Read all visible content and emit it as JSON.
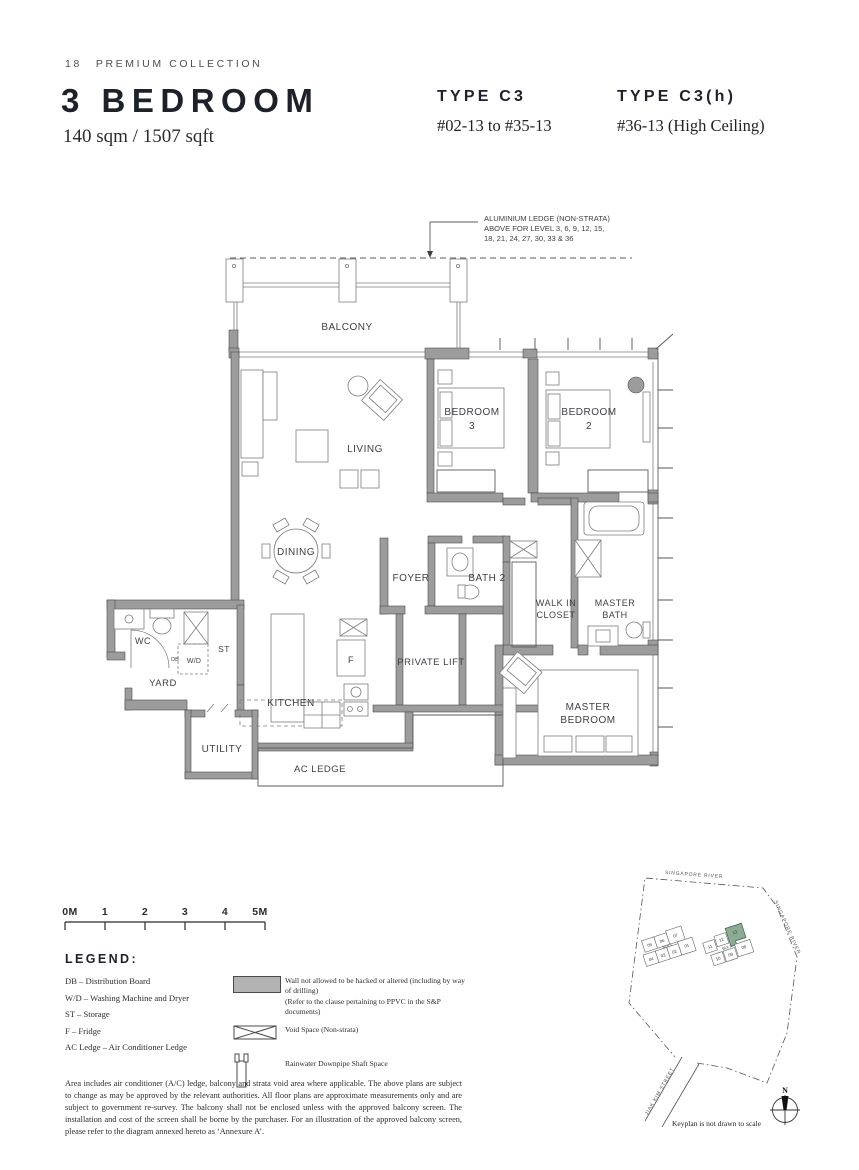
{
  "header": {
    "page_number": "18",
    "collection": "PREMIUM COLLECTION",
    "title": "3 BEDROOM",
    "area": "140 sqm / 1507 sqft",
    "type1": {
      "name": "TYPE C3",
      "units": "#02-13 to #35-13"
    },
    "type2": {
      "name": "TYPE C3(h)",
      "units": "#36-13 (High Ceiling)"
    }
  },
  "annotation": {
    "lines": [
      "ALUMINIUM LEDGE (NON-STRATA)",
      "ABOVE FOR LEVEL 3, 6, 9, 12, 15,",
      "18, 21, 24, 27, 30, 33 & 36"
    ]
  },
  "plan": {
    "balcony": "BALCONY",
    "living": "LIVING",
    "bedroom3": [
      "BEDROOM",
      "3"
    ],
    "bedroom2": [
      "BEDROOM",
      "2"
    ],
    "dining": "DINING",
    "foyer": "FOYER",
    "bath2": "BATH 2",
    "walk_in_closet": [
      "WALK IN",
      "CLOSET"
    ],
    "master_bath": [
      "MASTER",
      "BATH"
    ],
    "private_lift": "PRIVATE LIFT",
    "master_bedroom": [
      "MASTER",
      "BEDROOM"
    ],
    "kitchen": "KITCHEN",
    "utility": "UTILITY",
    "ac_ledge": "AC LEDGE",
    "yard": "YARD",
    "wc": "WC",
    "st": "ST",
    "wd": "W/D",
    "db": "DB",
    "fridge": "F"
  },
  "scale_bar": {
    "labels": [
      "0M",
      "1",
      "2",
      "3",
      "4",
      "5M"
    ]
  },
  "legend": {
    "title": "LEGEND:",
    "abbreviations": [
      "DB – Distribution Board",
      "W/D – Washing Machine and Dryer",
      "ST – Storage",
      "F – Fridge",
      "AC Ledge – Air Conditioner Ledge"
    ],
    "symbols": [
      {
        "name": "wall-no-hack",
        "line1": "Wall not allowed to be hacked or altered (including by way of drilling)",
        "line2": "(Refer to the clause pertaining to PPVC in the S&P documents)"
      },
      {
        "name": "void-space",
        "line1": "Void Space (Non-strata)"
      },
      {
        "name": "rainwater-downpipe",
        "line1": "Rainwater Downpipe Shaft Space"
      }
    ]
  },
  "disclaimer": "Area includes air conditioner (A/C) ledge, balcony and strata void area where applicable. The above plans are subject to change as may be approved by the relevant authorities. All floor plans are approximate measurements only and are subject to government re-survey. The balcony shall not be enclosed unless with the approved balcony screen. The installation and cost of the screen shall be borne by the purchaser. For an illustration of the approved balcony screen, please refer to the diagram annexed hereto as ‘Annexure A’.",
  "keyplan": {
    "river_label_top": "SINGAPORE RIVER",
    "river_label_right": "SINGAPORE RIVER",
    "street_label": "JIAK KIM STREET",
    "note": "Keyplan is not drawn to scale",
    "north": "N",
    "blk1": "BLK 1",
    "blk2": "BLK 2",
    "blk1_units_top": [
      "05",
      "06",
      "07"
    ],
    "blk1_units_bottom": [
      "04",
      "03",
      "02",
      "01"
    ],
    "blk2_units_top": [
      "11",
      "12",
      "13"
    ],
    "blk2_units_bottom": [
      "10",
      "09",
      "08"
    ],
    "highlighted_unit": "13"
  },
  "colors": {
    "wall_gray": "#9c9c9c",
    "keyplan_highlight": "#8cab92"
  }
}
